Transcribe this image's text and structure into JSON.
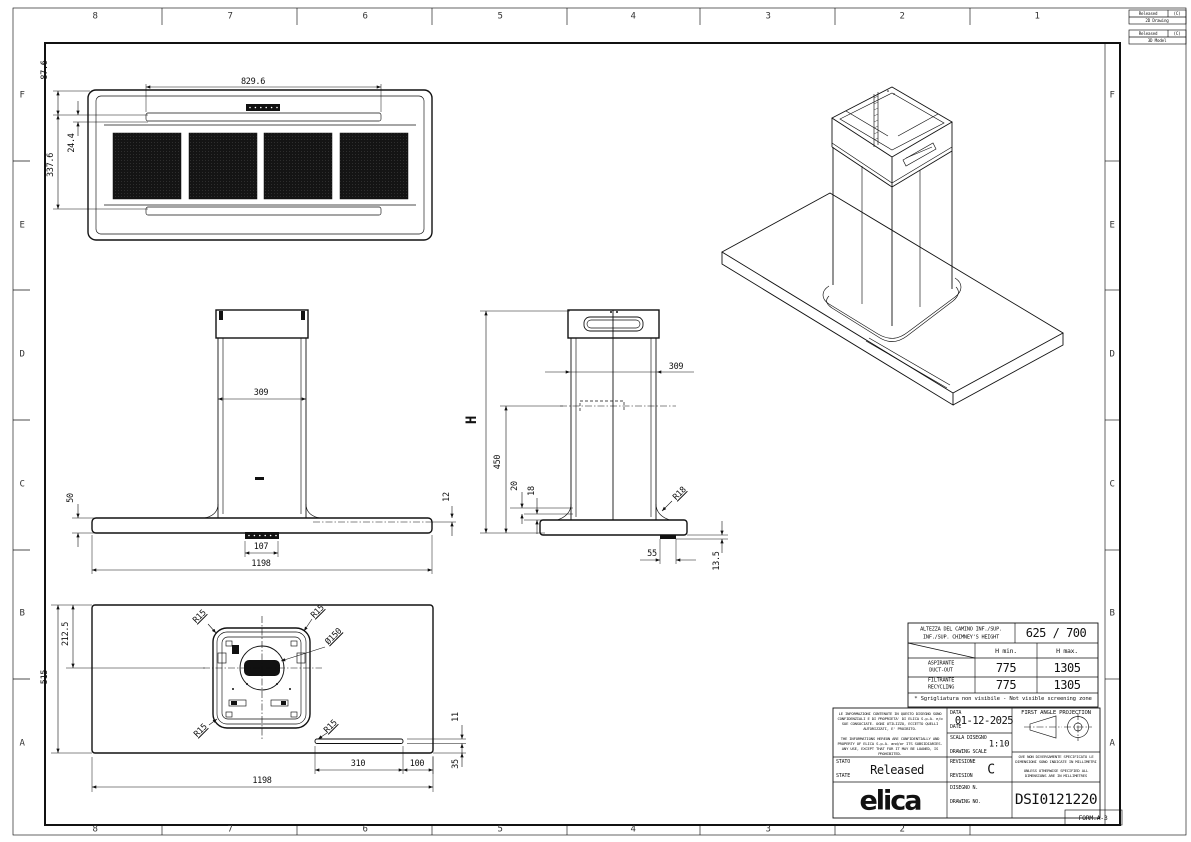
{
  "sheet": {
    "zones_top": [
      "8",
      "7",
      "6",
      "5",
      "4",
      "3",
      "2",
      "1"
    ],
    "zones_bottom": [
      "8",
      "7",
      "6",
      "5",
      "4",
      "3",
      "2"
    ],
    "zones_left": [
      "F",
      "E",
      "D",
      "C",
      "B",
      "A"
    ],
    "zones_right": [
      "F",
      "E",
      "D",
      "C",
      "B",
      "A"
    ],
    "form_label": "FORM.A-3"
  },
  "corner_flags": [
    {
      "status": "Released",
      "rev": "(C)",
      "kind": "2D Drawing"
    },
    {
      "status": "Released",
      "rev": "(C)",
      "kind": "3D Model"
    }
  ],
  "dims": {
    "v829": "829.6",
    "v87": "87.6",
    "v24": "24.4",
    "v337": "337.6",
    "v309": "309",
    "v50": "50",
    "v12": "12",
    "v107": "107",
    "v1198": "1198",
    "vH": "H",
    "v450": "450",
    "v20": "20",
    "v18": "18",
    "vR18": "R18",
    "v55": "55",
    "v135": "13.5",
    "v2125": "212.5",
    "v515": "515",
    "vR15": "R15",
    "vD150": "Ø150",
    "v11": "11",
    "v35": "35",
    "v310": "310",
    "v100": "100"
  },
  "table": {
    "title_it": "ALTEZZA DEL CAMINO INF./SUP.",
    "title_en": "INF./SUP. CHIMNEY'S HEIGHT",
    "title_value": "625 / 700",
    "col_min": "H min.",
    "col_max": "H max.",
    "rows": [
      {
        "label_it": "ASPIRANTE",
        "label_en": "DUCT-OUT",
        "min": "775",
        "max": "1305"
      },
      {
        "label_it": "FILTRANTE",
        "label_en": "RECYCLING",
        "min": "775",
        "max": "1305"
      }
    ],
    "footnote": "* Sgrigliatura non visibile - Not visible screening zone"
  },
  "titleblock": {
    "confidential_it": "LE INFORMAZIONI CONTENUTE IN QUESTO DISEGNO SONO CONFIDENZIALI E DI PROPRIETA' DI ELICA S.p.A. e/o SUE CONSOCIATE. OGNI UTILIZZO, ECCETTO QUELLI AUTORIZZATI, E' PROIBITO.",
    "confidential_en": "THE INFORMATIONS HEREON ARE CONFIDENTIALLY AND PROPERTY OF ELICA S.p.A. and/or ITS SUBSIDIARIES. ANY USE, EXCEPT THAT FOR IT MAY BE LOANED, IS PROHIBITED.",
    "date_label_it": "DATA",
    "date_label_en": "DATE",
    "date_value": "01-12-2025",
    "scale_label_it": "SCALA DISEGNO",
    "scale_label_en": "DRAWING SCALE",
    "scale_value": "1:10",
    "state_label_it": "STATO",
    "state_label_en": "STATE",
    "state_value": "Released",
    "rev_label_it": "REVISIONE",
    "rev_label_en": "REVISION",
    "rev_value": "C",
    "dwg_label_it": "DISEGNO N.",
    "dwg_label_en": "DRAWING NO.",
    "dwg_value": "DSI0121220",
    "projection_label": "FIRST ANGLE PROJECTION",
    "units_note_it": "OVE NON DIVERSAMENTE SPECIFICATO LE DIMENSIONI SONO INDICATE IN MILLIMETRI",
    "units_note_en": "UNLESS OTHERWISE SPECIFIED ALL DIMENSIONS ARE IN MILLIMETRES",
    "logo": "elica"
  },
  "colors": {
    "line": "#111111",
    "paper": "#ffffff",
    "panel_fill": "#141414"
  }
}
